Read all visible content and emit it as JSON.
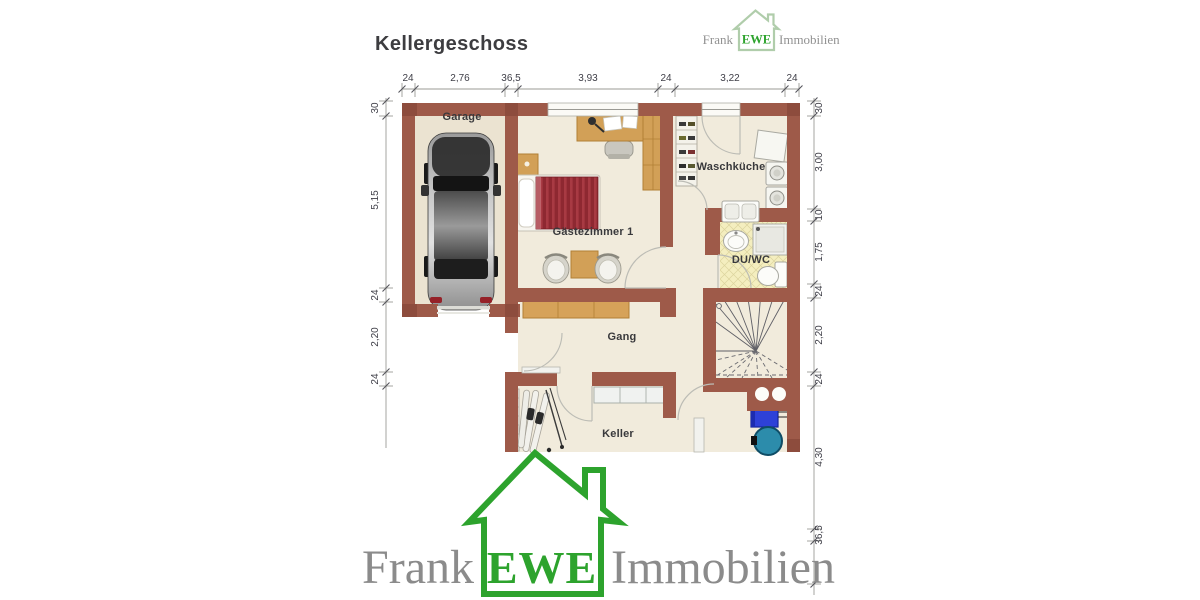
{
  "title": "Kellergeschoss",
  "brand": {
    "word1": "Frank",
    "word2": "EWE",
    "word3": "Immobilien"
  },
  "rooms": {
    "garage": "Garage",
    "guest_room": "Gästezimmer 1",
    "laundry": "Waschküche",
    "shower_wc": "DU/WC",
    "hallway": "Gang",
    "cellar": "Keller"
  },
  "dimensions": {
    "top": [
      "24",
      "2,76",
      "36,5",
      "3,93",
      "24",
      "3,22",
      "24"
    ],
    "left": [
      "30",
      "5,15",
      "24",
      "2,20",
      "24"
    ],
    "right": [
      "30",
      "3,00",
      "10",
      "1,75",
      "24",
      "2,20",
      "24",
      "4,30",
      "36,5"
    ]
  },
  "symbols": {
    "car": "car-top-view-icon",
    "bed": "single-bed-icon",
    "desk": "desk-with-chair-icon",
    "wardrobe": "wardrobe-icon",
    "chairs": "chair-icon",
    "washers": "washing-machine-icon",
    "shoe_shelf": "shelf-icon",
    "sink": "sink-icon",
    "shower": "shower-icon",
    "toilet": "toilet-icon",
    "stairs": "winding-staircase-icon",
    "skis": "ski-equipment-icon",
    "heater": "heater-icon",
    "boiler": "boiler-tank-icon",
    "chimney": "chimney-flues-icon",
    "house_logo": "house-outline-icon"
  },
  "colors": {
    "wall": "#9e5a49",
    "wall_accent": "#8d4c3d",
    "floor": "#f1ebdc",
    "floor_garage": "#ebe3d1",
    "tile": "#f4eebf",
    "wood": "#d2a057",
    "bed_red": "#8e2831",
    "logo_green": "#2da32d",
    "logo_green_light": "#b0cdab",
    "logo_gray": "#8b8b8b",
    "heater_blue": "#2e41d8",
    "boiler_teal": "#2c8cab"
  }
}
